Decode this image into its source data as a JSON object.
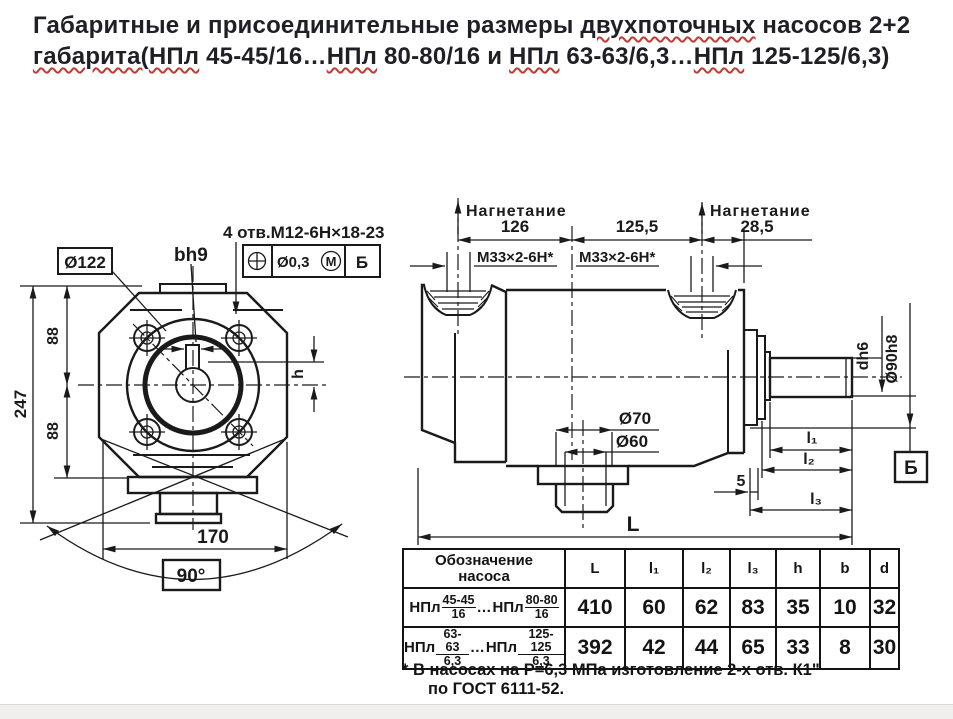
{
  "page": {
    "background": "#ffffff",
    "line_color": "#1a1a1a",
    "title_color": "#201f26",
    "squiggle_color": "#c23b32",
    "bottom_bar_color": "#f0efee"
  },
  "title": {
    "line1": [
      {
        "t": "Габаритные и присоединительные размеры ",
        "w": false
      },
      {
        "t": "двухпоточных",
        "w": true
      },
      {
        "t": " насосов 2+2",
        "w": false
      }
    ],
    "line2": [
      {
        "t": "габарита(",
        "w": true
      },
      {
        "t": "НПл",
        "w": true
      },
      {
        "t": " 45-45/16…",
        "w": false
      },
      {
        "t": "НПл",
        "w": true
      },
      {
        "t": " 80-80/16  и ",
        "w": false
      },
      {
        "t": "НПл",
        "w": true
      },
      {
        "t": " 63-63/6,3…",
        "w": false
      },
      {
        "t": "НПл",
        "w": true
      },
      {
        "t": " 125-125/6,3)",
        "w": false
      }
    ]
  },
  "front_view": {
    "labels": {
      "d122": "Ø122",
      "bh9": "bh9",
      "holes": "4 отв.М12-6Н×18-23",
      "fcf_tol": "Ø0,3",
      "fcf_mod": "М",
      "fcf_datum": "Б",
      "dim_247": "247",
      "dim_88_top": "88",
      "dim_88_bottom": "88",
      "dim_170": "170",
      "angle": "90°",
      "dim_h": "h"
    }
  },
  "side_view": {
    "labels": {
      "discharge_left": "Нагнетание",
      "discharge_right": "Нагнетание",
      "dim_126": "126",
      "dim_125_5": "125,5",
      "dim_28_5": "28,5",
      "thread_left": "М33×2-6Н*",
      "thread_right": "М33×2-6Н*",
      "dia_70": "Ø70",
      "dia_60": "Ø60",
      "shaft_dia": "dh6",
      "flange_dia": "Ø90h8",
      "dim_l1": "l₁",
      "dim_l2": "l₂",
      "dim_l3": "l₃",
      "dim_5": "5",
      "dim_L": "L",
      "datum": "Б"
    }
  },
  "table": {
    "header": {
      "name_line1": "Обозначение",
      "name_line2": "насоса",
      "cols": [
        "L",
        "l₁",
        "l₂",
        "l₃",
        "h",
        "b",
        "d"
      ]
    },
    "rows": [
      {
        "name": {
          "prefix1": "НПл",
          "num1": "45-45",
          "den1": "16",
          "sep": "…",
          "prefix2": "НПл",
          "num2": "80-80",
          "den2": "16"
        },
        "values": [
          "410",
          "60",
          "62",
          "83",
          "35",
          "10",
          "32"
        ]
      },
      {
        "name": {
          "prefix1": "НПл",
          "num1": "63-63",
          "den1": "6,3",
          "sep": "…",
          "prefix2": "НПл",
          "num2": "125-125",
          "den2": "6,3"
        },
        "values": [
          "392",
          "42",
          "44",
          "65",
          "33",
          "8",
          "30"
        ]
      }
    ]
  },
  "footnote": {
    "line1": "* В насосах на Р=6,3 МПа изготовление 2-х отв. К1\"",
    "line2": "по ГОСТ 6111-52."
  }
}
